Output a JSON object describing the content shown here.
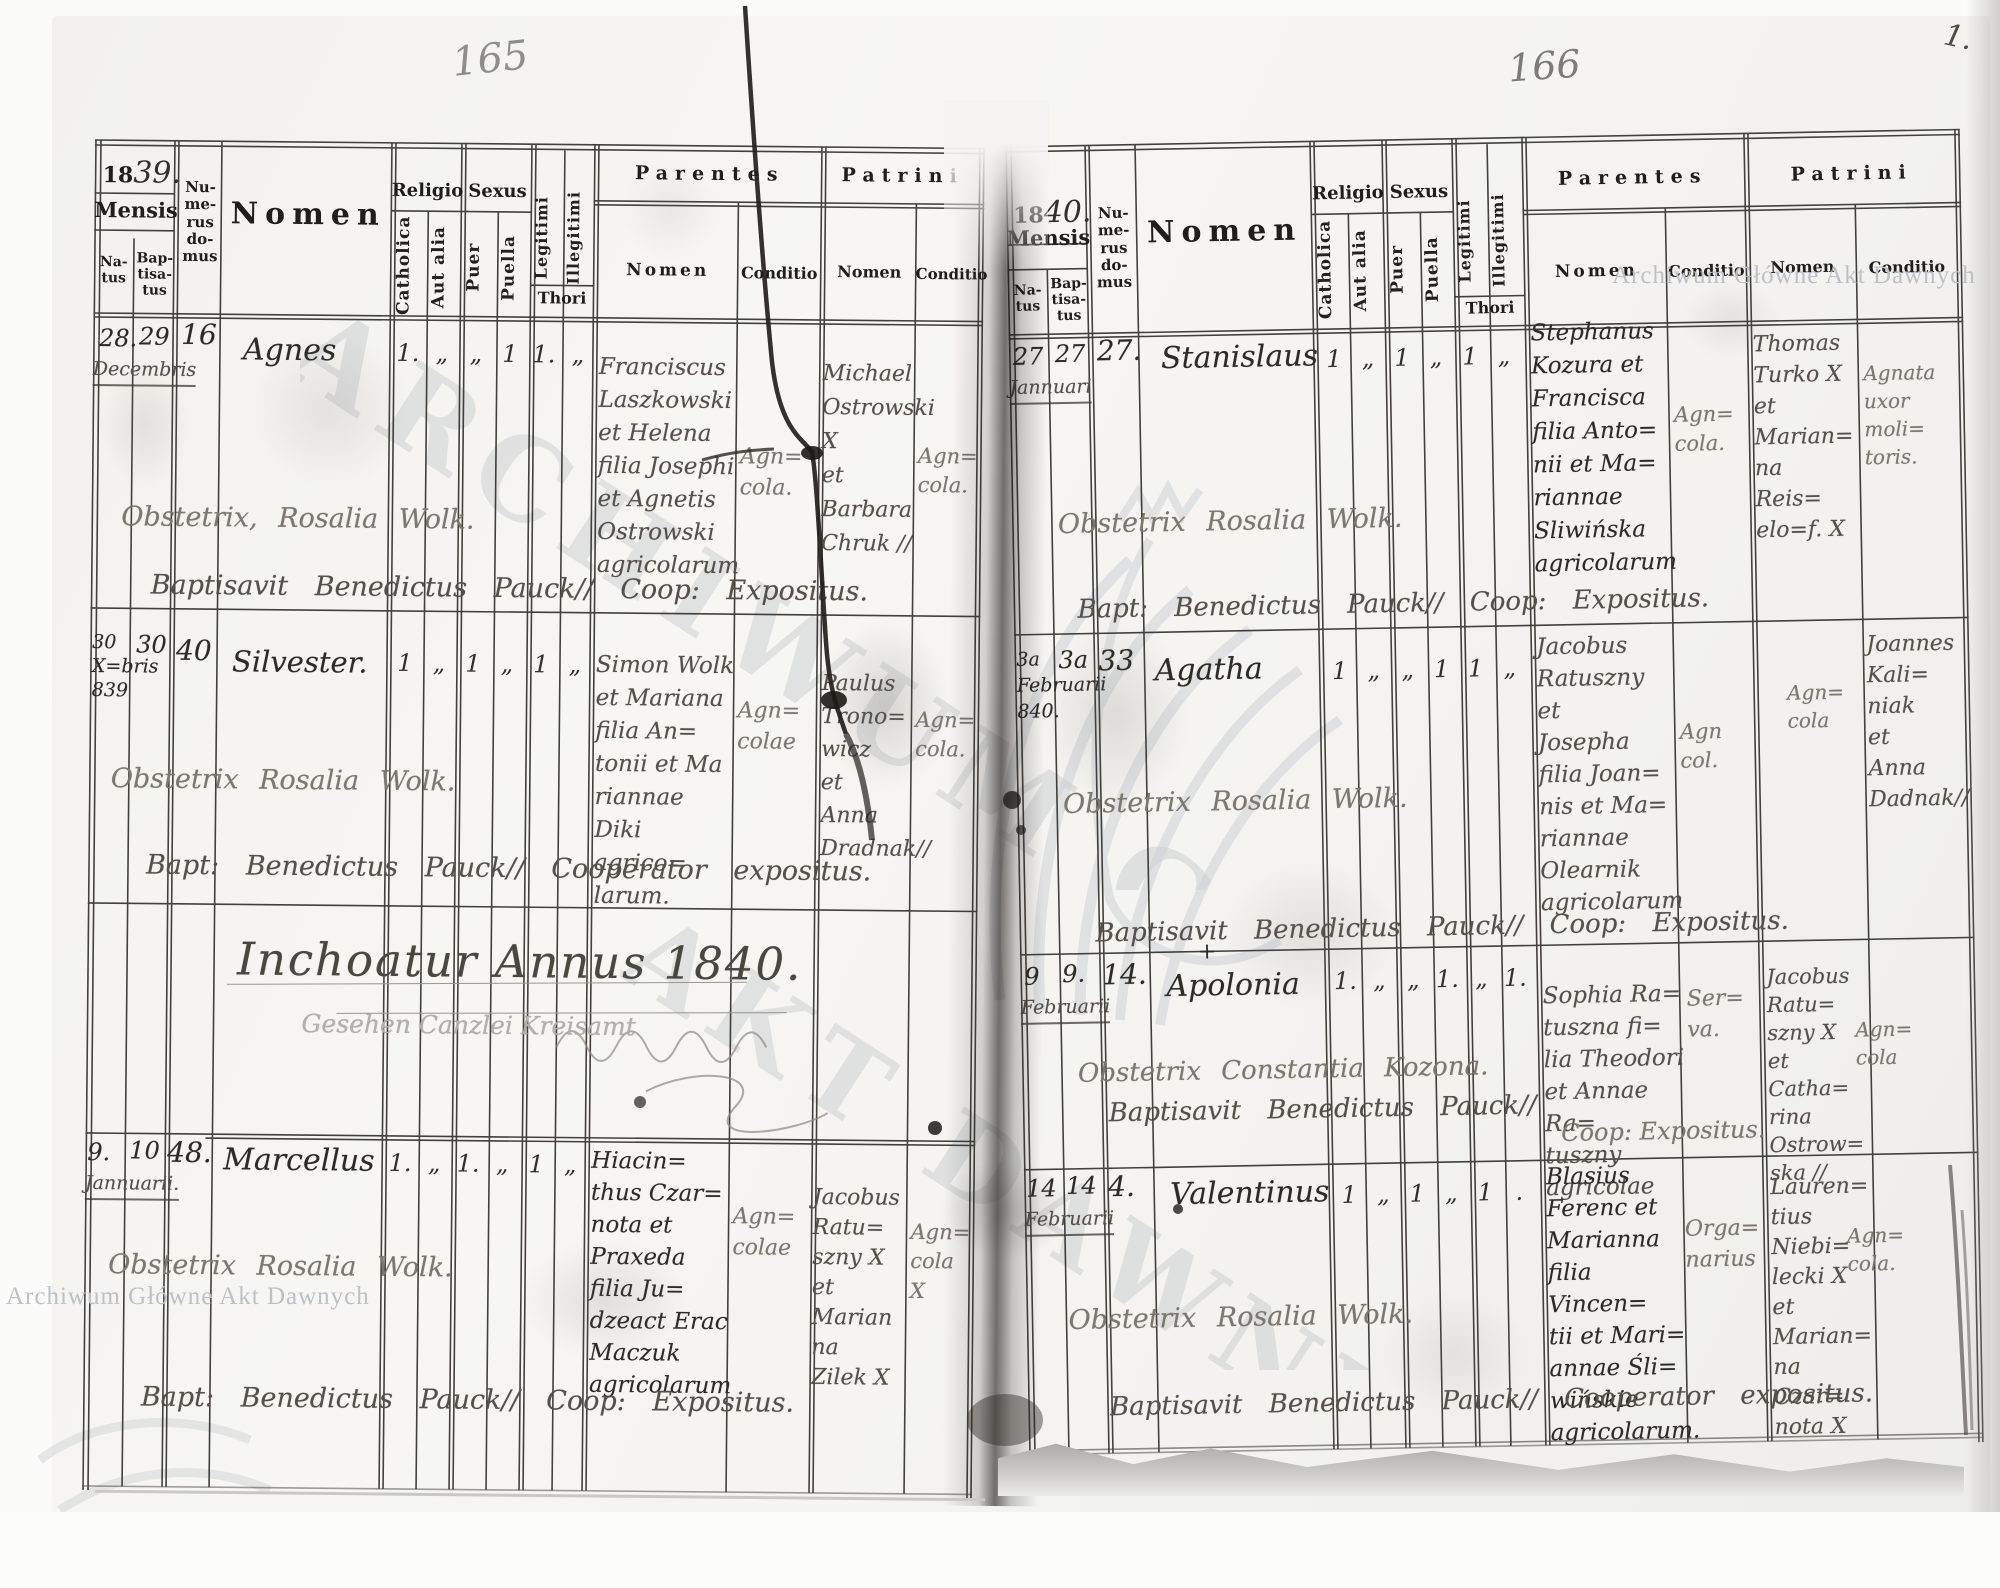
{
  "wm": {
    "small": "Archiwum Główne Akt Dawnych",
    "big1": "ARCHIWUM GŁÓWNE",
    "big2": "AKT DAWNYCH"
  },
  "folio": {
    "l": "165",
    "r": "166",
    "corner": "1."
  },
  "cols": {
    "mensis": "Mensis",
    "natus": "Na-\ntus",
    "baptisatus": "Bap-\ntisa-\ntus",
    "numerus": "Nu-\nme-\nrus\ndo-\nmus",
    "nomen": "Nomen",
    "religio": "Religio",
    "catholica": "Catholica",
    "aut_alia": "Aut alia",
    "sexus": "Sexus",
    "puer": "Puer",
    "puella": "Puella",
    "legitimi": "Legitimi",
    "illegitimi": "Illegitimi",
    "thori": "Thori",
    "parentes": "Parentes",
    "patrini": "Patrini",
    "sub_nomen": "Nomen",
    "conditio": "Conditio"
  },
  "lp": {
    "yp": "18",
    "ys": "39.",
    "inch": "Inchoatur Annus 1840.",
    "pencil": "Gesehen Canzlei Kreisamt",
    "e": [
      {
        "n": "28.",
        "b": "29",
        "mo": "Decembris",
        "h": "16",
        "nm": "Agnes",
        "mk": [
          "1.",
          "„",
          "„",
          "1",
          "1.",
          "„"
        ],
        "pn": "Franciscus\nLaszkowski\net Helena\nfilia Josephi\net Agnetis\nOstrowski\nagricolarum",
        "pc": "Agn=\ncola.",
        "tn": "Michael\nOstrowski X\net\nBarbara\nChruk //",
        "tc": "Agn=\ncola.",
        "ob": "Obstetrix, Rosalia Wolk.",
        "bp": "Baptisavit Benedictus Pauck// Coop: Expositus."
      },
      {
        "n": "30\nX=bris\n839",
        "b": "30",
        "mo": "",
        "h": "40",
        "nm": "Silvester.",
        "mk": [
          "1",
          "„",
          "1",
          "„",
          "1",
          "„"
        ],
        "pn": "Simon Wolk\net Mariana\nfilia An=\ntonii et Ma\nriannae\nDiki agrico=\nlarum.",
        "pc": "Agn=\ncolae",
        "tn": "Paulus\nTrono=\nwicz\net\nAnna\nDradnak//",
        "tc": "Agn=\ncola.",
        "ob": "Obstetrix Rosalia Wolk.",
        "bp": "Bapt: Benedictus Pauck// Cooperator expositus."
      },
      {
        "n": "9.",
        "b": "10",
        "mo": "Jannuarii.",
        "h": "48.",
        "nm": "Marcellus",
        "mk": [
          "1.",
          "„",
          "1.",
          "„",
          "1",
          "„"
        ],
        "pn": "Hiacin=\nthus Czar=\nnota et\nPraxeda\nfilia Ju=\ndzeact Erac\nMaczuk\nagricolarum",
        "pc": "Agn=\ncolae",
        "tn": "Jacobus\nRatu=\nszny X\net\nMarian\nna\nZilek X",
        "tc": "Agn=\ncola X",
        "ob": "Obstetrix Rosalia Wolk.",
        "bp": "Bapt: Benedictus Pauck// Coop: Expositus."
      }
    ]
  },
  "rp": {
    "yp": "18",
    "ys": "40.",
    "e": [
      {
        "n": "27",
        "b": "27",
        "mo": "Jannuari",
        "h": "27.",
        "nm": "Stanislaus",
        "mk": [
          "1",
          "„",
          "1",
          "„",
          "1",
          "„"
        ],
        "pn": "Stephanus\nKozura et\nFrancisca\nfilia Anto=\nnii et Ma=\nriannae\nSliwińska\nagricolarum",
        "pc": "Agn=\ncola.",
        "tn": "Thomas\nTurko X\net\nMarian=\nna\nReis=\nelo=f. X",
        "tc": "Agnata\nuxor\nmoli=\ntoris.",
        "ob": "Obstetrix Rosalia Wolk.",
        "bp": "Bapt: Benedictus Pauck// Coop: Expositus."
      },
      {
        "n": "3a\nFebruarii\n840.",
        "b": "3a",
        "mo": "",
        "h": "33",
        "nm": "Agatha",
        "mk": [
          "1",
          "„",
          "„",
          "1",
          "1",
          "„"
        ],
        "pn": "Jacobus\nRatuszny\net\nJosepha\nfilia Joan=\nnis et Ma=\nriannae\nOlearnik\nagricolarum",
        "pc": "Agn\ncol.",
        "tn": "Joannes\nKali=\nniak\net\nAnna\nDadnak//",
        "tc": "Agn=\ncola",
        "ob": "Obstetrix Rosalia Wolk.",
        "bp": "Baptisavit Benedictus Pauck// Coop: Expositus."
      },
      {
        "n": "9",
        "b": "9.",
        "mo": "Februarii",
        "h": "14.",
        "nm": "Apolonia",
        "cross": "+",
        "mk": [
          "1.",
          "„",
          "„",
          "1.",
          "„",
          "1."
        ],
        "pn": "Sophia Ra=\ntuszna fi=\nlia Theodori\net Annae Ra=\ntuszny agricolae",
        "pc": "Ser=\nva.",
        "cp": "Coop: Expositus.",
        "tn": "Jacobus\nRatu=\nszny X\net Catha=\nrina\nOstrow=\nska //",
        "tc": "Agn=\ncola",
        "ob": "Obstetrix Constantia Kozona.",
        "bp": "Baptisavit Benedictus Pauck//"
      },
      {
        "n": "14",
        "b": "14",
        "mo": "Februarii",
        "h": "4.",
        "nm": "Valentinus",
        "mk": [
          "1",
          "„",
          "1",
          "„",
          "1",
          "."
        ],
        "pn": "Blasius\nFerenc et\nMarianna\nfilia Vincen=\ntii et Mari=\nannae Śli=\nwińskie\nagricolarum.",
        "pc": "Orga=\nnarius",
        "tn": "Lauren=\ntius\nNiebi=\nlecki X\net\nMarian=\nna Czar=\nnota X",
        "tc": "Agn=\ncola.",
        "ob": "Obstetrix Rosalia Wolk.",
        "bp": "Baptisavit Benedictus Pauck// Cooperator expositus."
      }
    ]
  }
}
